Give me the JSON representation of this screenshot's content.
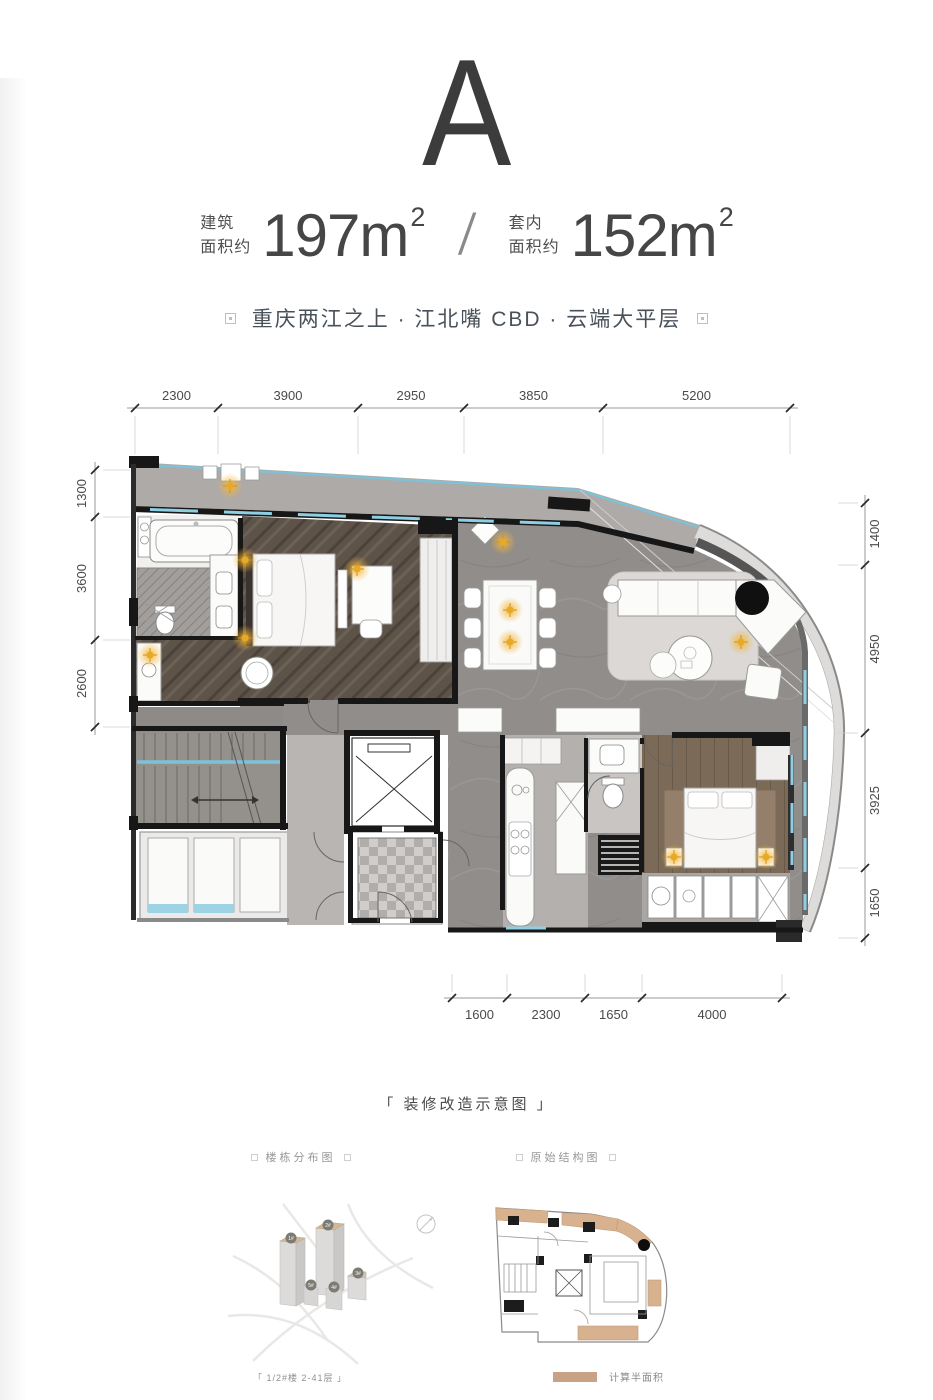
{
  "header": {
    "plan_letter": "A"
  },
  "area_info": {
    "build_label_1": "建筑",
    "build_label_2": "面积约",
    "build_value": "197m",
    "build_sup": "2",
    "divider": "/",
    "inner_label_1": "套内",
    "inner_label_2": "面积约",
    "inner_value": "152m",
    "inner_sup": "2"
  },
  "tagline": {
    "text": "重庆两江之上 · 江北嘴 CBD · 云端大平层"
  },
  "plan": {
    "dims_top": [
      "2300",
      "3900",
      "2950",
      "3850",
      "5200"
    ],
    "dims_left": [
      "1300",
      "3600",
      "2600"
    ],
    "dims_right": [
      "1400",
      "4950",
      "3925",
      "1650"
    ],
    "dims_bottom": [
      "1600",
      "2300",
      "1650",
      "4000"
    ],
    "watermark": "房天下 fang.com"
  },
  "footer": {
    "caption": "「 装修改造示意图 」",
    "left_diagram": {
      "title": "楼栋分布图",
      "caption": "「 1/2#楼  2-41层 」",
      "towers": [
        "1#",
        "2#",
        "3#",
        "4#",
        "5#"
      ]
    },
    "right_diagram": {
      "title": "原始结构图",
      "legend": "计算半面积",
      "legend_color": "#c9a184"
    }
  },
  "colors": {
    "glass": "#7cc3d9",
    "lamp": "#f4b63a",
    "legend_tan": "#c9a184",
    "wall": "#171717"
  }
}
